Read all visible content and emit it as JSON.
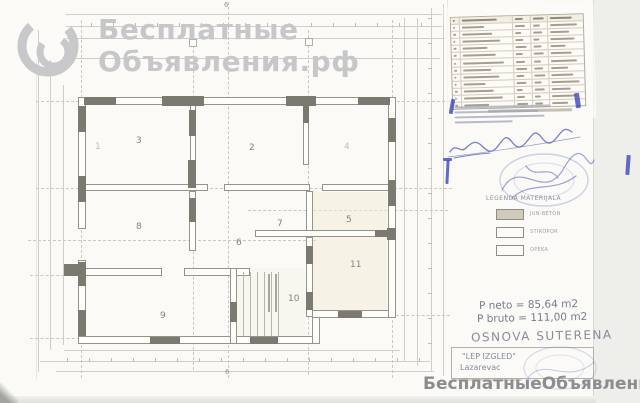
{
  "watermark_top": {
    "line1": "Бесплатные",
    "line2": "Объявления.рф"
  },
  "watermark_bottom": {
    "text": "БесплатныеОбъявления.рф"
  },
  "plan": {
    "rooms": [
      {
        "label": "1",
        "x": 95,
        "y": 142,
        "faint": true
      },
      {
        "label": "2",
        "x": 249,
        "y": 143
      },
      {
        "label": "3",
        "x": 136,
        "y": 136
      },
      {
        "label": "4",
        "x": 344,
        "y": 142,
        "faint": true
      },
      {
        "label": "5",
        "x": 346,
        "y": 215
      },
      {
        "label": "6",
        "x": 236,
        "y": 238
      },
      {
        "label": "7",
        "x": 277,
        "y": 219
      },
      {
        "label": "8",
        "x": 136,
        "y": 222
      },
      {
        "label": "9",
        "x": 160,
        "y": 311
      },
      {
        "label": "10",
        "x": 288,
        "y": 294
      },
      {
        "label": "11",
        "x": 350,
        "y": 260
      }
    ],
    "axis_markers": [
      {
        "label": "6",
        "x": 224,
        "y": 1
      },
      {
        "label": "6",
        "x": 225,
        "y": 368
      }
    ]
  },
  "schedule": {
    "rows": 12
  },
  "legend": {
    "title": "LEGENDA MATERIJALA",
    "items": [
      {
        "label": "JUN-BETON",
        "filled": true
      },
      {
        "label": "STIROPOR",
        "filled": false
      },
      {
        "label": "OPEKA",
        "filled": false
      }
    ]
  },
  "summary": {
    "p_neto": "P neto =  85,64 m2",
    "p_bruto": "P bruto = 111,00 m2",
    "drawing_title": "OSNOVA SUTERENA"
  },
  "title_block": {
    "firm": "\"LEP IZGLED\"",
    "city": "Lazarevac"
  },
  "colors": {
    "ink_blue": "#3e4bc0",
    "watermark_gray": "#c7c7c9",
    "watermark_dark": "#8d8d8f"
  }
}
